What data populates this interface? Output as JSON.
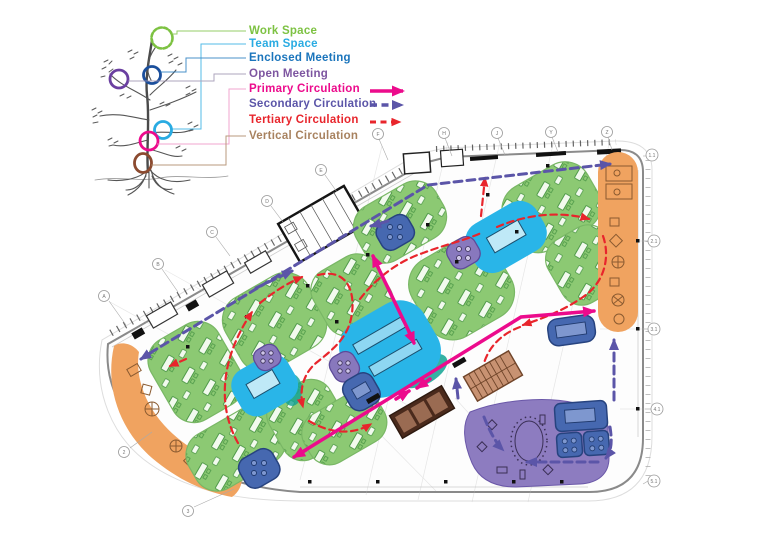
{
  "legend": {
    "items": [
      {
        "label": "Work Space",
        "color": "#7DC242",
        "swatch": "tree-circle"
      },
      {
        "label": "Team Space",
        "color": "#29ABE2",
        "swatch": "tree-circle"
      },
      {
        "label": "Enclosed Meeting",
        "color": "#1B75BC",
        "swatch": "tree-circle"
      },
      {
        "label": "Open Meeting",
        "color": "#7D55A0",
        "swatch": "tree-circle"
      },
      {
        "label": "Primary Circulation",
        "color": "#EC0B8C",
        "swatch": "solid-arrow"
      },
      {
        "label": "Secondary Circulation",
        "color": "#5B55A8",
        "swatch": "dashed-arrow"
      },
      {
        "label": "Tertiary Circulation",
        "color": "#E8252C",
        "swatch": "dashed-arrow"
      },
      {
        "label": "Vertical Circulation",
        "color": "#A8825F",
        "swatch": "tree-circle"
      }
    ]
  },
  "plan": {
    "grid": {
      "top": [
        "F",
        "H",
        "J",
        "Y",
        "Z"
      ],
      "left": [
        "A",
        "B",
        "C",
        "D",
        "E"
      ],
      "right": [
        "1.1",
        "2.1",
        "3.1",
        "4.1",
        "5.1"
      ],
      "bottom": [
        "2",
        "3"
      ]
    },
    "zone_colors": {
      "work_space": "#8CC973",
      "team_space": "#29B5E8",
      "enclosed_meeting": "#4668B0",
      "open_meeting": "#8878BD",
      "primary_circulation": "#EC0B8C",
      "secondary_circulation": "#5B55A8",
      "tertiary_circulation": "#E8252C",
      "vertical_circulation": "#8B5A3C",
      "perimeter_support": "#F0A360"
    }
  }
}
